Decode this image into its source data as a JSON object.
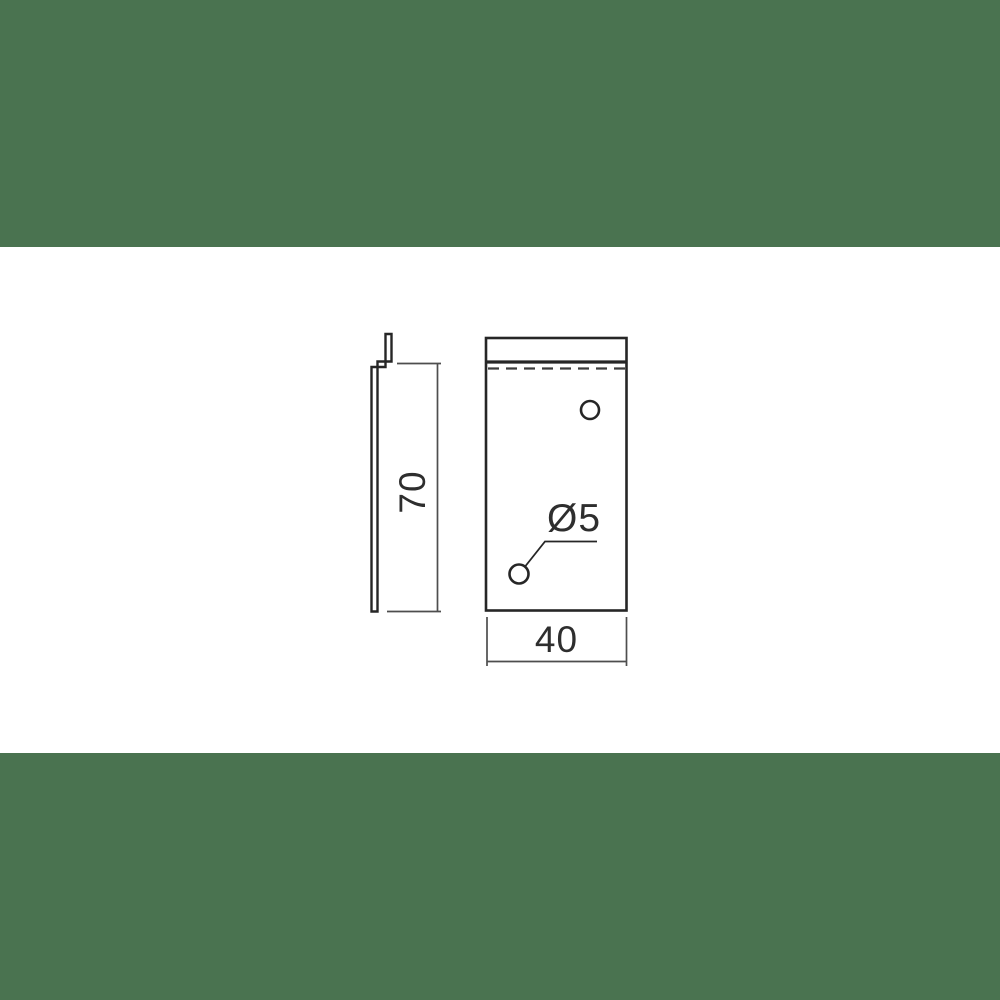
{
  "drawing": {
    "dimensions": {
      "height_label": "70",
      "width_label": "40",
      "hole_diameter_label": "Ø5"
    },
    "colors": {
      "band_green": "#4a7350",
      "canvas_white": "#ffffff",
      "object_line": "#262626",
      "dimension_line": "#4e4e4e",
      "text": "#2e2e2e"
    }
  }
}
